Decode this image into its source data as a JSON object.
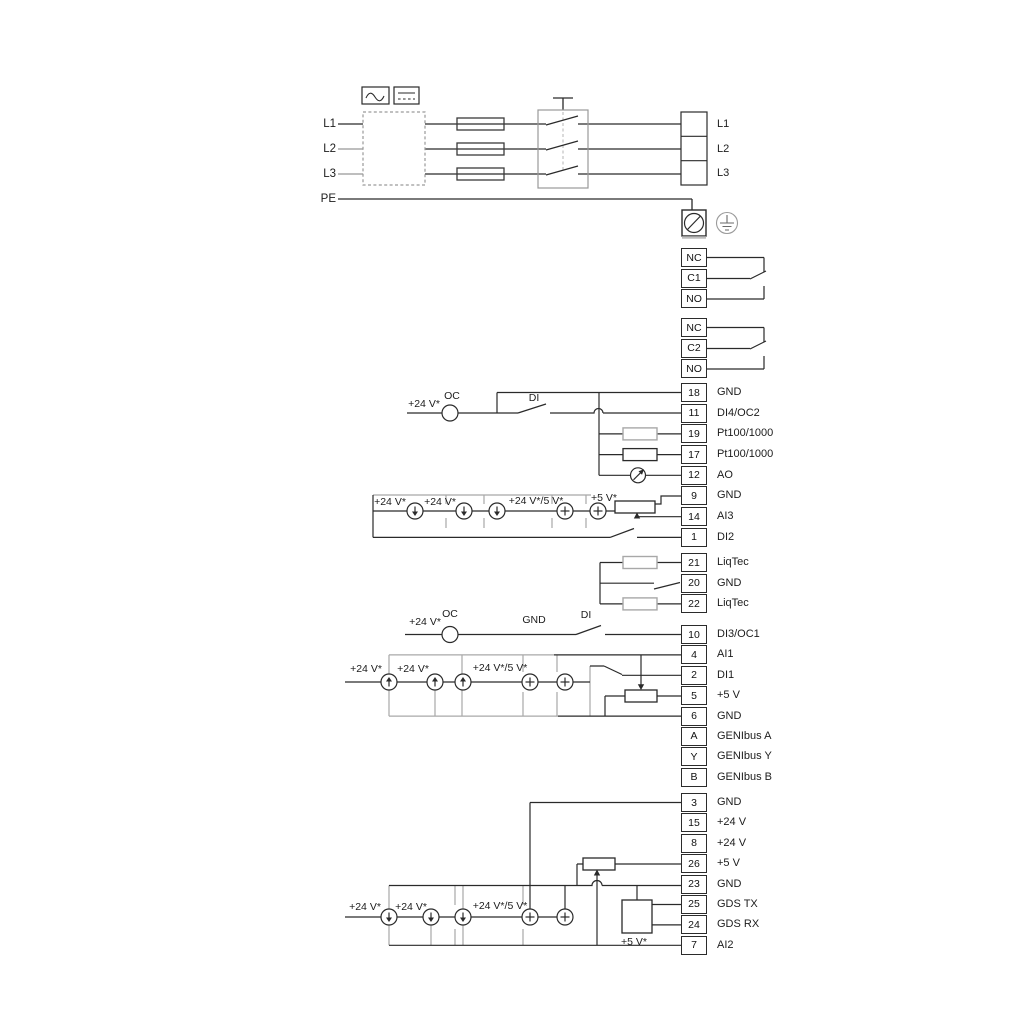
{
  "power": {
    "inputs": [
      "L1",
      "L2",
      "L3",
      "PE"
    ],
    "outputs": [
      "L1",
      "L2",
      "L3"
    ]
  },
  "relays": [
    {
      "cells": [
        "NC",
        "C1",
        "NO"
      ]
    },
    {
      "cells": [
        "NC",
        "C2",
        "NO"
      ]
    }
  ],
  "labels": {
    "v24": "+24 V*",
    "v24or5": "+24 V*/5 V*",
    "v5": "+5 V*",
    "oc": "OC",
    "di": "DI",
    "gnd": "GND"
  },
  "groups": {
    "io1": [
      {
        "num": "18",
        "label": "GND"
      },
      {
        "num": "11",
        "label": "DI4/OC2"
      },
      {
        "num": "19",
        "label": "Pt100/1000"
      },
      {
        "num": "17",
        "label": "Pt100/1000"
      },
      {
        "num": "12",
        "label": "AO"
      },
      {
        "num": "9",
        "label": "GND"
      },
      {
        "num": "14",
        "label": "AI3"
      },
      {
        "num": "1",
        "label": "DI2"
      }
    ],
    "liqtec": [
      {
        "num": "21",
        "label": "LiqTec"
      },
      {
        "num": "20",
        "label": "GND"
      },
      {
        "num": "22",
        "label": "LiqTec"
      }
    ],
    "io2": [
      {
        "num": "10",
        "label": "DI3/OC1"
      },
      {
        "num": "4",
        "label": "AI1"
      },
      {
        "num": "2",
        "label": "DI1"
      },
      {
        "num": "5",
        "label": "+5 V"
      },
      {
        "num": "6",
        "label": "GND"
      },
      {
        "num": "A",
        "label": "GENIbus A"
      },
      {
        "num": "Y",
        "label": "GENIbus Y"
      },
      {
        "num": "B",
        "label": "GENIbus B"
      }
    ],
    "io3": [
      {
        "num": "3",
        "label": "GND"
      },
      {
        "num": "15",
        "label": "+24 V"
      },
      {
        "num": "8",
        "label": "+24 V"
      },
      {
        "num": "26",
        "label": "+5 V"
      },
      {
        "num": "23",
        "label": "GND"
      },
      {
        "num": "25",
        "label": "GDS TX"
      },
      {
        "num": "24",
        "label": "GDS RX"
      },
      {
        "num": "7",
        "label": "AI2"
      }
    ]
  },
  "colors": {
    "wire": "#2a2a2a",
    "wire_gray": "#a8a8a8"
  }
}
